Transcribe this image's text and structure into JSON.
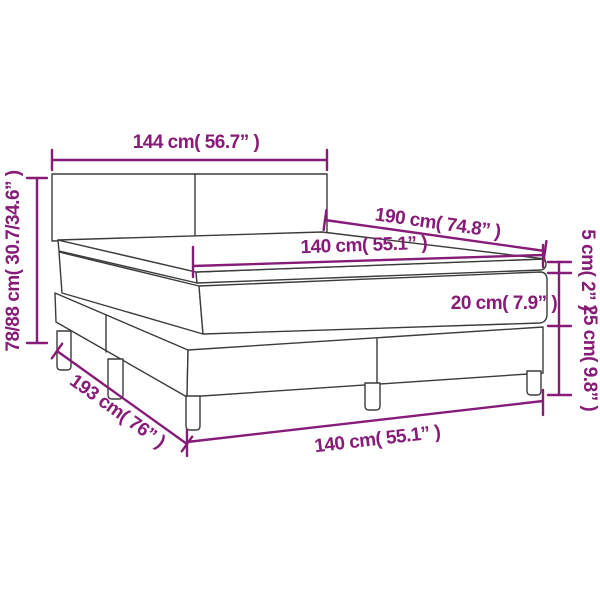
{
  "diagram": {
    "title": "box-spring-bed-dimension-diagram",
    "subject": "Box spring bed with headboard, mattress topper, mattress, slatted base box and legs",
    "colors": {
      "dimension_annotation": "#871b78",
      "bed_outline": "#3b3b3a",
      "background": "#ffffff"
    },
    "dimensions": {
      "headboard_width": "144 cm( 56.7” )",
      "total_height": "78/88 cm( 30.7/34.6” )",
      "mattress_length": "190 cm( 74.8” )",
      "mattress_width_top": "140 cm( 55.1” )",
      "topper_height": "5 cm( 2” )",
      "mattress_height": "20 cm( 7.9” )",
      "base_height": "25 cm( 9.8” )",
      "total_length": "193 cm( 76” )",
      "mattress_width_bottom": "140 cm( 55.1” )"
    }
  }
}
